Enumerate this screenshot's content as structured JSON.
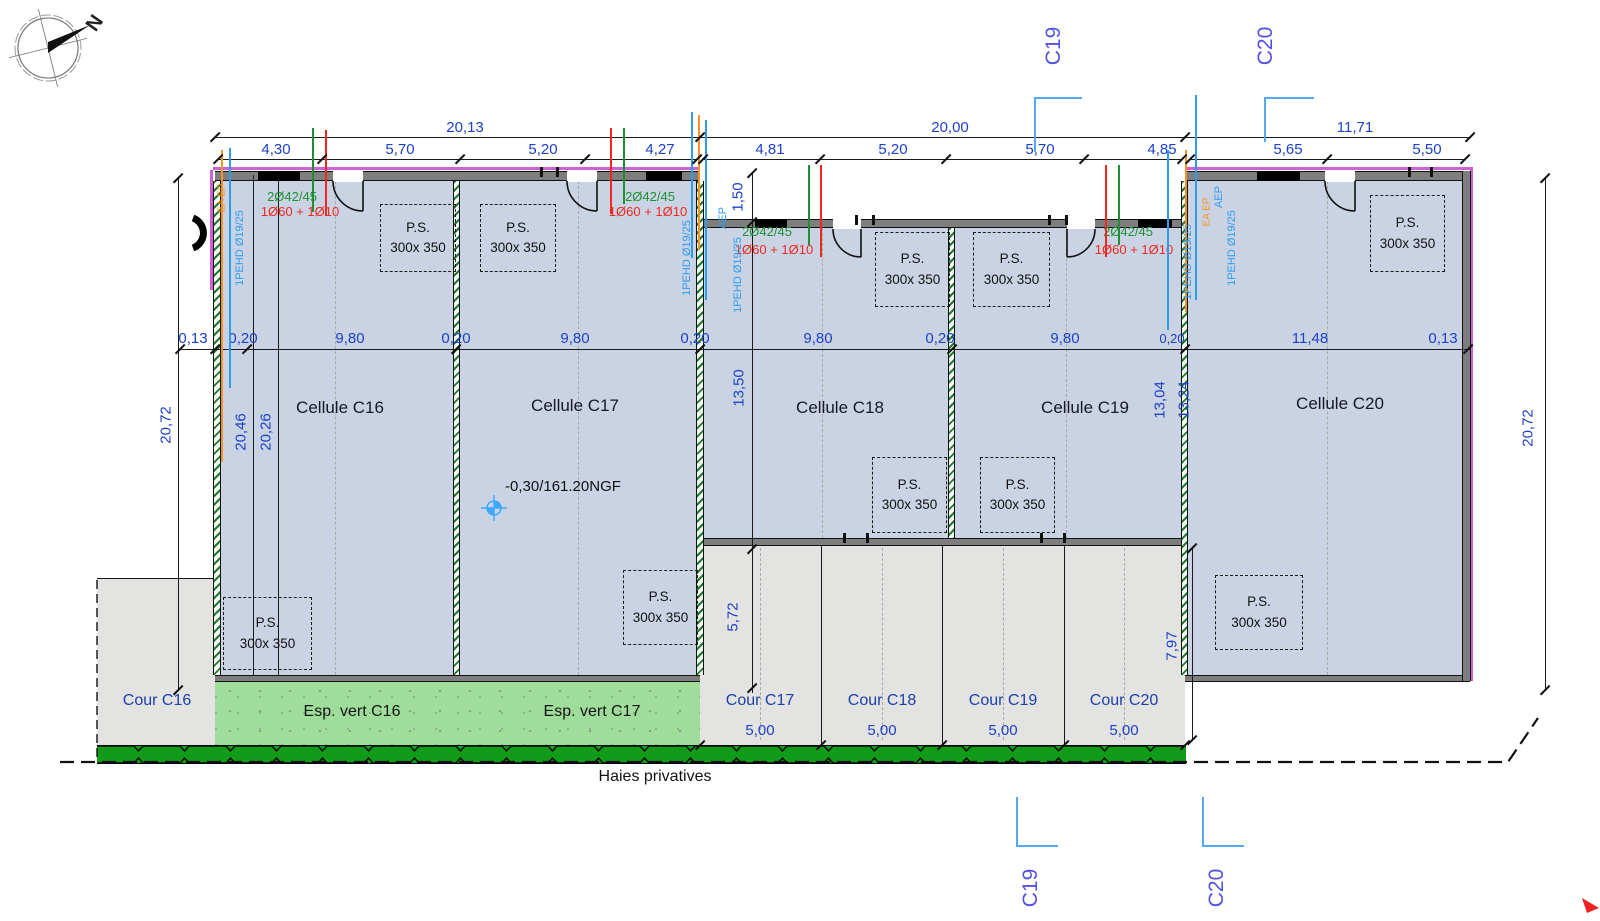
{
  "compass": {
    "north": "N"
  },
  "markers": {
    "c19": "C19",
    "c20": "C20"
  },
  "dims": {
    "s1": {
      "total": "20,13",
      "p1": "4,30",
      "p2": "5,70",
      "p3": "5,20",
      "p4": "4,27"
    },
    "s2": {
      "total": "20,00",
      "p1": "4,81",
      "p2": "5,20",
      "p3": "5,70",
      "p4": "4,85"
    },
    "s3": {
      "total": "11,71",
      "p1": "5,65",
      "p2": "5,50"
    },
    "mid": {
      "m1": "0,13",
      "m2": "0,20",
      "m3": "9,80",
      "m4": "0,20",
      "m5": "9,80",
      "m6": "0,20",
      "m7": "9,80",
      "m8": "0,20",
      "m9": "9,80",
      "m10": "0,20",
      "m11": "11,48",
      "m12": "0,13"
    },
    "v": {
      "left_total": "20,72",
      "in1": "20,46",
      "in2": "20,26",
      "offset": "1,50",
      "mid": "13,50",
      "r1": "13,04",
      "r2": "13,24",
      "right_total": "20,72",
      "court1": "5,72",
      "court2": "7,97"
    }
  },
  "cells": {
    "c16": "Cellule C16",
    "c17": "Cellule C17",
    "c18": "Cellule C18",
    "c19": "Cellule C19",
    "c20": "Cellule C20"
  },
  "level": "-0,30/161.20NGF",
  "ps": {
    "l1": "P.S.",
    "l2": "300x 350"
  },
  "courts": {
    "c16": "Cour C16",
    "c17": "Cour C17",
    "c18": "Cour C18",
    "c19": "Cour C19",
    "c20": "Cour C20",
    "width": "5,00"
  },
  "landscape": {
    "esp16": "Esp. vert C16",
    "esp17": "Esp. vert C17",
    "hedge": "Haies privatives"
  },
  "rebar": {
    "green": "2Ø42/45",
    "red": "1Ø60 + 1Ø10"
  },
  "pipes": {
    "pehd": "1PEHD Ø19/25",
    "aep": "AEP",
    "eaep": "EA EP"
  },
  "colors": {
    "cell_fill": "#c9d3e4",
    "court_fill": "#e3e3e1",
    "green_fill": "#9fde9a",
    "hedge_fill": "#119b18",
    "magenta": "#cf5fd6",
    "dim_blue": "#1d41c8",
    "marker_blue": "#5352e0",
    "pipe_blue": "#2f9bf0",
    "orange": "#f59422",
    "rebar_green": "#1f9032",
    "rebar_red": "#f2281e"
  }
}
